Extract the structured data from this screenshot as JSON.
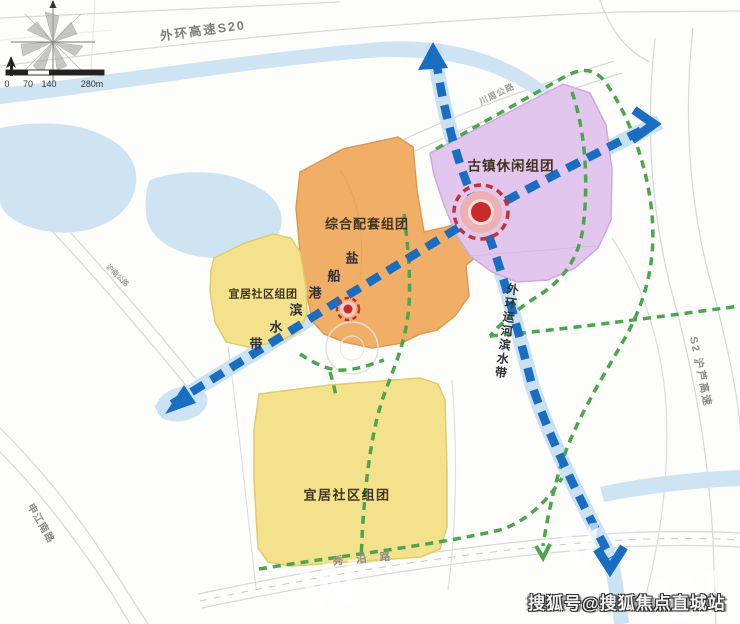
{
  "map": {
    "title_context": "规划组团示意图",
    "zones": {
      "comprehensive": {
        "label": "综合配套组团",
        "color": "#f1ae66"
      },
      "ancient_town": {
        "label": "古镇休闲组团",
        "color": "#e2c6ee"
      },
      "residential_west": {
        "label": "宜居社区组团",
        "color": "#f4e18c"
      },
      "residential_south": {
        "label": "宜居社区组团",
        "color": "#f4e18c"
      }
    },
    "corridors": {
      "yanchuangang": {
        "name": "盐船港滨水带",
        "chars": [
          "盐",
          "船",
          "港",
          "滨",
          "水",
          "带"
        ],
        "color": "#1a6ec2"
      },
      "waihuan_canal": {
        "name": "外环运河滨水带",
        "color": "#1a6ec2"
      },
      "greenway_color": "#4ca64c"
    },
    "roads": {
      "s20": "外环高速S20",
      "chuanzhou": "川周公路",
      "s2": "S2 沪芦高速",
      "shenjiang": "申江南路",
      "hunan": "沪南公路",
      "xiuyan": "秀沿路"
    },
    "nodes": {
      "main_node_color": "#cc2a2a",
      "secondary_node_color": "#cc2a2a"
    },
    "scale": {
      "ticks": [
        "0",
        "70",
        "140",
        "280m"
      ]
    },
    "water_color": "#cfe4f3",
    "watermark": {
      "text": "搜狐号@搜狐焦点直城站"
    }
  }
}
